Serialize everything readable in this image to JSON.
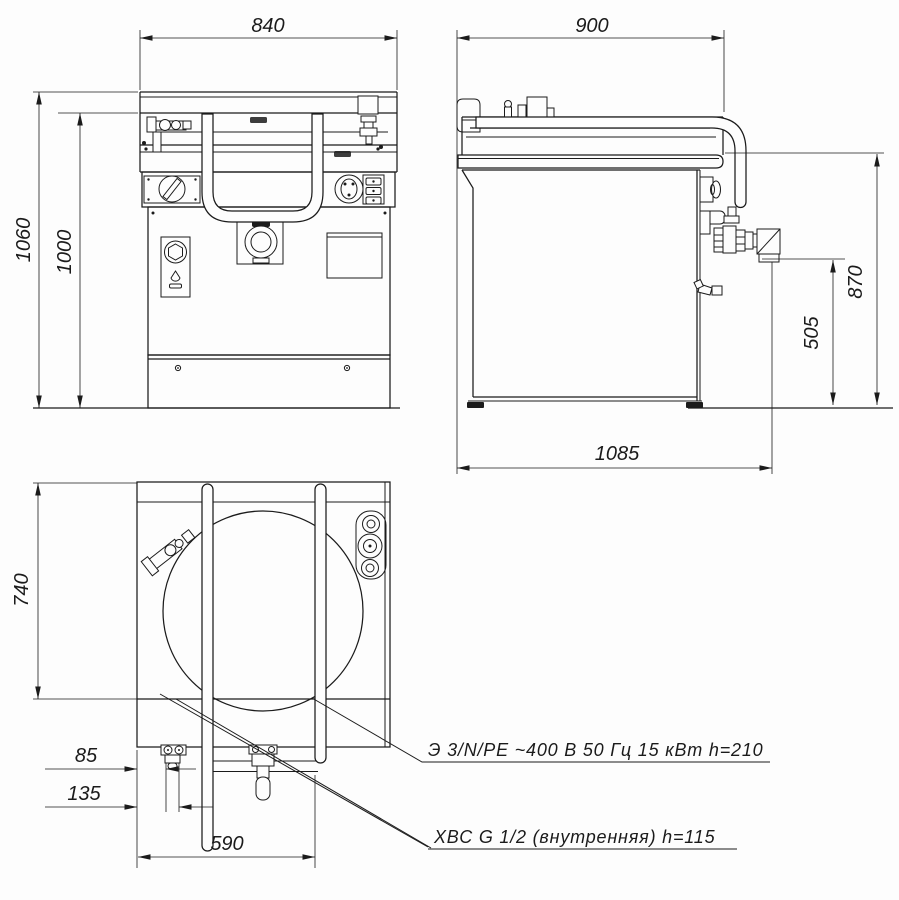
{
  "drawing": {
    "dims": {
      "front_width": "840",
      "front_overall_height": "1060",
      "front_body_height": "1000",
      "side_width": "900",
      "side_worktop_height": "870",
      "side_drain_height": "505",
      "side_overall_depth": "1085",
      "top_depth": "740",
      "top_inlet_offset_1": "85",
      "top_inlet_offset_2": "135",
      "top_front_width": "590"
    },
    "notes": {
      "electrical": "Э 3/N/PE ~400 В 50 Гц 15 кВт h=210",
      "water": "ХВС G 1/2 (внутренняя)  h=115"
    },
    "colors": {
      "line": "#1b1b1b",
      "background": "#ffffff"
    }
  }
}
